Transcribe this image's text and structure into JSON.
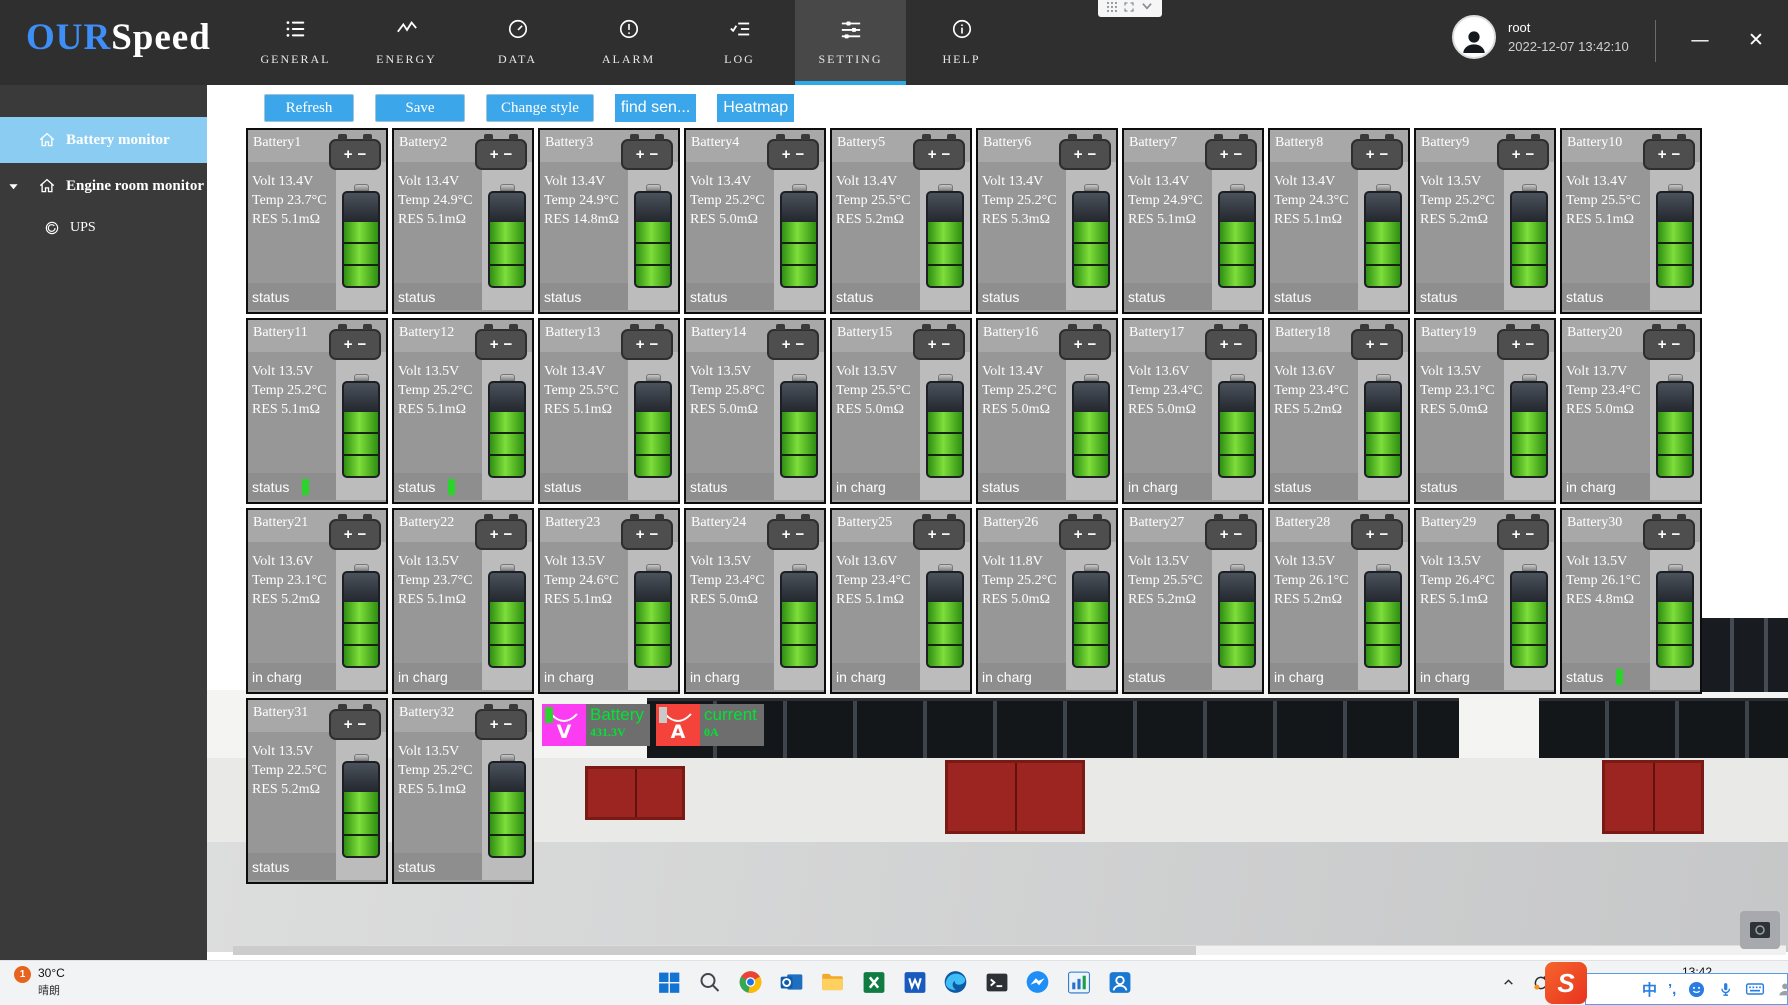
{
  "window": {
    "logo": {
      "our": "OUR",
      "speed": "Speed"
    },
    "user": {
      "name": "root",
      "datetime": "2022-12-07 13:42:10"
    },
    "controls": {
      "minimize": "—",
      "close": "✕"
    }
  },
  "nav": {
    "tabs": [
      {
        "label": "GENERAL",
        "icon": "list",
        "active": false
      },
      {
        "label": "ENERGY",
        "icon": "energy",
        "active": false
      },
      {
        "label": "DATA",
        "icon": "gauge",
        "active": false
      },
      {
        "label": "ALARM",
        "icon": "alarm",
        "active": false
      },
      {
        "label": "LOG",
        "icon": "log",
        "active": false
      },
      {
        "label": "SETTING",
        "icon": "sliders",
        "active": true
      },
      {
        "label": "HELP",
        "icon": "info",
        "active": false
      }
    ]
  },
  "sidebar": {
    "items": [
      {
        "label": "Battery monitor",
        "icon": "home",
        "active": true,
        "expandable": false,
        "sub": false
      },
      {
        "label": "Engine room monitor",
        "icon": "home",
        "active": false,
        "expandable": true,
        "sub": false
      },
      {
        "label": "UPS",
        "icon": "ups",
        "active": false,
        "expandable": false,
        "sub": true
      }
    ]
  },
  "toolbar": {
    "buttons": [
      {
        "label": "Refresh",
        "style": "classic"
      },
      {
        "label": "Save",
        "style": "classic"
      },
      {
        "label": "Change style",
        "style": "classic"
      },
      {
        "label": "find sen...",
        "style": "flat"
      },
      {
        "label": "Heatmap",
        "style": "flat"
      }
    ]
  },
  "batteries": [
    {
      "name": "Battery1",
      "volt": "Volt 13.4V",
      "temp": "Temp 23.7°C",
      "res": "RES 5.1mΩ",
      "status": "status",
      "ind": ""
    },
    {
      "name": "Battery2",
      "volt": "Volt 13.4V",
      "temp": "Temp 24.9°C",
      "res": "RES 5.1mΩ",
      "status": "status",
      "ind": ""
    },
    {
      "name": "Battery3",
      "volt": "Volt 13.4V",
      "temp": "Temp 24.9°C",
      "res": "RES 14.8mΩ",
      "status": "status",
      "ind": ""
    },
    {
      "name": "Battery4",
      "volt": "Volt 13.4V",
      "temp": "Temp 25.2°C",
      "res": "RES 5.0mΩ",
      "status": "status",
      "ind": ""
    },
    {
      "name": "Battery5",
      "volt": "Volt 13.4V",
      "temp": "Temp 25.5°C",
      "res": "RES 5.2mΩ",
      "status": "status",
      "ind": ""
    },
    {
      "name": "Battery6",
      "volt": "Volt 13.4V",
      "temp": "Temp 25.2°C",
      "res": "RES 5.3mΩ",
      "status": "status",
      "ind": ""
    },
    {
      "name": "Battery7",
      "volt": "Volt 13.4V",
      "temp": "Temp 24.9°C",
      "res": "RES 5.1mΩ",
      "status": "status",
      "ind": ""
    },
    {
      "name": "Battery8",
      "volt": "Volt 13.4V",
      "temp": "Temp 24.3°C",
      "res": "RES 5.1mΩ",
      "status": "status",
      "ind": ""
    },
    {
      "name": "Battery9",
      "volt": "Volt 13.5V",
      "temp": "Temp 25.2°C",
      "res": "RES 5.2mΩ",
      "status": "status",
      "ind": ""
    },
    {
      "name": "Battery10",
      "volt": "Volt 13.4V",
      "temp": "Temp 25.5°C",
      "res": "RES 5.1mΩ",
      "status": "status",
      "ind": ""
    },
    {
      "name": "Battery11",
      "volt": "Volt 13.5V",
      "temp": "Temp 25.2°C",
      "res": "RES 5.1mΩ",
      "status": "status",
      "ind": "green"
    },
    {
      "name": "Battery12",
      "volt": "Volt 13.5V",
      "temp": "Temp 25.2°C",
      "res": "RES 5.1mΩ",
      "status": "status",
      "ind": "green"
    },
    {
      "name": "Battery13",
      "volt": "Volt 13.4V",
      "temp": "Temp 25.5°C",
      "res": "RES 5.1mΩ",
      "status": "status",
      "ind": ""
    },
    {
      "name": "Battery14",
      "volt": "Volt 13.5V",
      "temp": "Temp 25.8°C",
      "res": "RES 5.0mΩ",
      "status": "status",
      "ind": ""
    },
    {
      "name": "Battery15",
      "volt": "Volt 13.5V",
      "temp": "Temp 25.5°C",
      "res": "RES 5.0mΩ",
      "status": "in charg",
      "ind": ""
    },
    {
      "name": "Battery16",
      "volt": "Volt 13.4V",
      "temp": "Temp 25.2°C",
      "res": "RES 5.0mΩ",
      "status": "status",
      "ind": ""
    },
    {
      "name": "Battery17",
      "volt": "Volt 13.6V",
      "temp": "Temp 23.4°C",
      "res": "RES 5.0mΩ",
      "status": "in charg",
      "ind": ""
    },
    {
      "name": "Battery18",
      "volt": "Volt 13.6V",
      "temp": "Temp 23.4°C",
      "res": "RES 5.2mΩ",
      "status": "status",
      "ind": ""
    },
    {
      "name": "Battery19",
      "volt": "Volt 13.5V",
      "temp": "Temp 23.1°C",
      "res": "RES 5.0mΩ",
      "status": "status",
      "ind": ""
    },
    {
      "name": "Battery20",
      "volt": "Volt 13.7V",
      "temp": "Temp 23.4°C",
      "res": "RES 5.0mΩ",
      "status": "in charg",
      "ind": ""
    },
    {
      "name": "Battery21",
      "volt": "Volt 13.6V",
      "temp": "Temp 23.1°C",
      "res": "RES 5.2mΩ",
      "status": "in charg",
      "ind": ""
    },
    {
      "name": "Battery22",
      "volt": "Volt 13.5V",
      "temp": "Temp 23.7°C",
      "res": "RES 5.1mΩ",
      "status": "in charg",
      "ind": ""
    },
    {
      "name": "Battery23",
      "volt": "Volt 13.5V",
      "temp": "Temp 24.6°C",
      "res": "RES 5.1mΩ",
      "status": "in charg",
      "ind": ""
    },
    {
      "name": "Battery24",
      "volt": "Volt 13.5V",
      "temp": "Temp 23.4°C",
      "res": "RES 5.0mΩ",
      "status": "in charg",
      "ind": ""
    },
    {
      "name": "Battery25",
      "volt": "Volt 13.6V",
      "temp": "Temp 23.4°C",
      "res": "RES 5.1mΩ",
      "status": "in charg",
      "ind": ""
    },
    {
      "name": "Battery26",
      "volt": "Volt 11.8V",
      "temp": "Temp 25.2°C",
      "res": "RES 5.0mΩ",
      "status": "in charg",
      "ind": ""
    },
    {
      "name": "Battery27",
      "volt": "Volt 13.5V",
      "temp": "Temp 25.5°C",
      "res": "RES 5.2mΩ",
      "status": "status",
      "ind": ""
    },
    {
      "name": "Battery28",
      "volt": "Volt 13.5V",
      "temp": "Temp 26.1°C",
      "res": "RES 5.2mΩ",
      "status": "in charg",
      "ind": ""
    },
    {
      "name": "Battery29",
      "volt": "Volt 13.5V",
      "temp": "Temp 26.4°C",
      "res": "RES 5.1mΩ",
      "status": "in charg",
      "ind": ""
    },
    {
      "name": "Battery30",
      "volt": "Volt 13.5V",
      "temp": "Temp 26.1°C",
      "res": "RES 4.8mΩ",
      "status": "status",
      "ind": "green"
    },
    {
      "name": "Battery31",
      "volt": "Volt 13.5V",
      "temp": "Temp 22.5°C",
      "res": "RES 5.2mΩ",
      "status": "status",
      "ind": ""
    },
    {
      "name": "Battery32",
      "volt": "Volt 13.5V",
      "temp": "Temp 25.2°C",
      "res": "RES 5.1mΩ",
      "status": "status",
      "ind": ""
    }
  ],
  "gauges": {
    "voltage": {
      "symbol": "V",
      "label": "Battery",
      "value": "431.3V",
      "accent": "#fb3cf2",
      "bar": "#2bd42b"
    },
    "current": {
      "symbol": "A",
      "label": "current",
      "value": "0A",
      "accent": "#f4433a",
      "bar": "#c9c9c9"
    }
  },
  "taskbar": {
    "weather": {
      "badge": "1",
      "temp": "30°C",
      "desc": "晴朗"
    },
    "icons": [
      "start",
      "search",
      "chrome",
      "outlook",
      "folder",
      "excel",
      "word",
      "edge",
      "terminal",
      "messenger",
      "stats",
      "monitor"
    ],
    "tray": {
      "lang_cn": "中",
      "lang_pinyin": "拼",
      "time": "13:42"
    },
    "ime": {
      "logo": "S",
      "mode": "中",
      "punct": "’,",
      "person_badge": "10"
    }
  }
}
